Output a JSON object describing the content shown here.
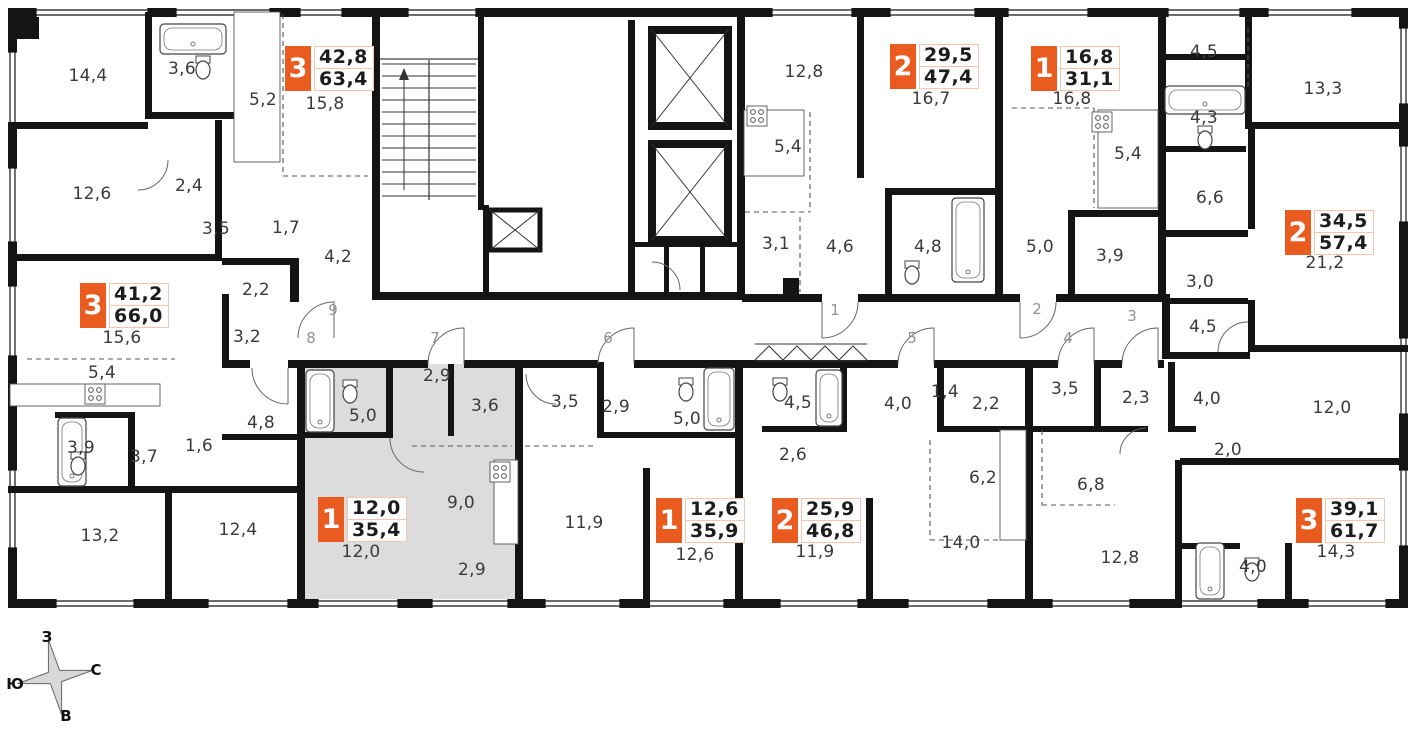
{
  "badge_color": "#EA5B1F",
  "highlight_color": "#dcdcdc",
  "apartments": [
    {
      "type": "3",
      "area_living": "42,8",
      "area_total": "63,4",
      "badge": {
        "x": 285,
        "y": 46
      },
      "rooms": [
        {
          "label": "15,8",
          "x": 325,
          "y": 104
        },
        {
          "label": "14,4",
          "x": 88,
          "y": 76
        },
        {
          "label": "3,6",
          "x": 182,
          "y": 69
        },
        {
          "label": "5,2",
          "x": 263,
          "y": 100
        },
        {
          "label": "12,6",
          "x": 92,
          "y": 194
        },
        {
          "label": "2,4",
          "x": 189,
          "y": 186
        },
        {
          "label": "3,5",
          "x": 216,
          "y": 229
        },
        {
          "label": "1,7",
          "x": 286,
          "y": 228
        },
        {
          "label": "4,2",
          "x": 338,
          "y": 257
        }
      ]
    },
    {
      "type": "2",
      "area_living": "29,5",
      "area_total": "47,4",
      "badge": {
        "x": 890,
        "y": 44
      },
      "rooms": [
        {
          "label": "16,7",
          "x": 931,
          "y": 99
        },
        {
          "label": "12,8",
          "x": 804,
          "y": 72
        },
        {
          "label": "5,4",
          "x": 788,
          "y": 147
        },
        {
          "label": "3,1",
          "x": 776,
          "y": 244
        },
        {
          "label": "4,6",
          "x": 840,
          "y": 247
        },
        {
          "label": "4,8",
          "x": 928,
          "y": 247
        }
      ]
    },
    {
      "type": "1",
      "area_living": "16,8",
      "area_total": "31,1",
      "badge": {
        "x": 1031,
        "y": 46
      },
      "rooms": [
        {
          "label": "16,8",
          "x": 1072,
          "y": 99
        },
        {
          "label": "5,4",
          "x": 1128,
          "y": 154
        },
        {
          "label": "5,0",
          "x": 1040,
          "y": 247
        },
        {
          "label": "3,9",
          "x": 1110,
          "y": 256
        }
      ]
    },
    {
      "type": "2",
      "area_living": "34,5",
      "area_total": "57,4",
      "badge": {
        "x": 1285,
        "y": 210
      },
      "rooms": [
        {
          "label": "21,2",
          "x": 1325,
          "y": 263
        },
        {
          "label": "4,5",
          "x": 1204,
          "y": 52
        },
        {
          "label": "13,3",
          "x": 1323,
          "y": 89
        },
        {
          "label": "4,3",
          "x": 1204,
          "y": 118
        },
        {
          "label": "6,6",
          "x": 1210,
          "y": 198
        },
        {
          "label": "3,0",
          "x": 1200,
          "y": 282
        },
        {
          "label": "4,5",
          "x": 1203,
          "y": 327
        }
      ]
    },
    {
      "type": "3",
      "area_living": "41,2",
      "area_total": "66,0",
      "badge": {
        "x": 80,
        "y": 283
      },
      "rooms": [
        {
          "label": "15,6",
          "x": 122,
          "y": 338
        },
        {
          "label": "2,2",
          "x": 256,
          "y": 290
        },
        {
          "label": "3,2",
          "x": 247,
          "y": 337
        },
        {
          "label": "5,4",
          "x": 102,
          "y": 373
        },
        {
          "label": "3,9",
          "x": 81,
          "y": 448
        },
        {
          "label": "3,7",
          "x": 144,
          "y": 457
        },
        {
          "label": "1,6",
          "x": 199,
          "y": 446
        },
        {
          "label": "4,8",
          "x": 261,
          "y": 423
        },
        {
          "label": "13,2",
          "x": 100,
          "y": 536
        },
        {
          "label": "12,4",
          "x": 238,
          "y": 530
        }
      ]
    },
    {
      "type": "1",
      "area_living": "12,0",
      "area_total": "35,4",
      "badge": {
        "x": 318,
        "y": 497
      },
      "highlighted": true,
      "rooms": [
        {
          "label": "12,0",
          "x": 361,
          "y": 552
        },
        {
          "label": "5,0",
          "x": 363,
          "y": 416
        },
        {
          "label": "2,9",
          "x": 437,
          "y": 376
        },
        {
          "label": "3,6",
          "x": 485,
          "y": 406
        },
        {
          "label": "9,0",
          "x": 461,
          "y": 503
        },
        {
          "label": "2,9",
          "x": 472,
          "y": 570
        }
      ]
    },
    {
      "type": "1",
      "area_living": "12,6",
      "area_total": "35,9",
      "badge": {
        "x": 656,
        "y": 498
      },
      "rooms": [
        {
          "label": "12,6",
          "x": 695,
          "y": 555
        },
        {
          "label": "11,9",
          "x": 584,
          "y": 523
        },
        {
          "label": "3,5",
          "x": 565,
          "y": 402
        },
        {
          "label": "2,9",
          "x": 616,
          "y": 407
        },
        {
          "label": "5,0",
          "x": 687,
          "y": 419
        }
      ]
    },
    {
      "type": "2",
      "area_living": "25,9",
      "area_total": "46,8",
      "badge": {
        "x": 772,
        "y": 498
      },
      "rooms": [
        {
          "label": "11,9",
          "x": 815,
          "y": 552
        },
        {
          "label": "14,0",
          "x": 961,
          "y": 543
        },
        {
          "label": "4,5",
          "x": 798,
          "y": 403
        },
        {
          "label": "2,6",
          "x": 793,
          "y": 455
        },
        {
          "label": "4,0",
          "x": 898,
          "y": 404
        },
        {
          "label": "1,4",
          "x": 945,
          "y": 392
        },
        {
          "label": "2,2",
          "x": 986,
          "y": 404
        },
        {
          "label": "6,2",
          "x": 983,
          "y": 478
        }
      ]
    },
    {
      "type": "3",
      "area_living": "39,1",
      "area_total": "61,7",
      "badge": {
        "x": 1296,
        "y": 498
      },
      "rooms": [
        {
          "label": "14,3",
          "x": 1336,
          "y": 552
        },
        {
          "label": "12,0",
          "x": 1332,
          "y": 408
        },
        {
          "label": "3,5",
          "x": 1065,
          "y": 389
        },
        {
          "label": "2,3",
          "x": 1136,
          "y": 398
        },
        {
          "label": "4,0",
          "x": 1207,
          "y": 399
        },
        {
          "label": "2,0",
          "x": 1228,
          "y": 450
        },
        {
          "label": "6,8",
          "x": 1091,
          "y": 485
        },
        {
          "label": "12,8",
          "x": 1120,
          "y": 558
        },
        {
          "label": "4,0",
          "x": 1253,
          "y": 567
        }
      ]
    }
  ],
  "corridor_units": [
    {
      "label": "9",
      "x": 333,
      "y": 310
    },
    {
      "label": "8",
      "x": 311,
      "y": 338
    },
    {
      "label": "7",
      "x": 435,
      "y": 338
    },
    {
      "label": "6",
      "x": 608,
      "y": 338
    },
    {
      "label": "1",
      "x": 835,
      "y": 310
    },
    {
      "label": "5",
      "x": 912,
      "y": 338
    },
    {
      "label": "2",
      "x": 1037,
      "y": 309
    },
    {
      "label": "4",
      "x": 1068,
      "y": 338
    },
    {
      "label": "3",
      "x": 1132,
      "y": 316
    }
  ],
  "compass": {
    "west": "З",
    "north": "С",
    "south": "Ю",
    "east": "В"
  }
}
